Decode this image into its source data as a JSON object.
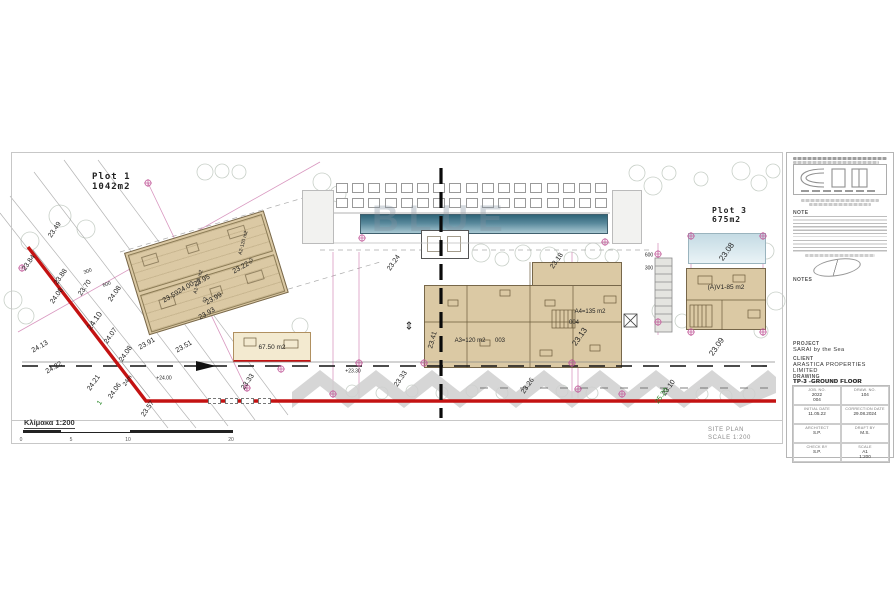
{
  "sheet": {
    "plot1": {
      "name": "Plot 1",
      "area": "1042m2"
    },
    "plot3": {
      "name": "Plot 3",
      "area": "675m2"
    },
    "scale_caption": "Κλίμακα 1:200",
    "scale_ticks": [
      "0",
      "5",
      "10",
      "20"
    ],
    "site_plan": {
      "line1": "SITE PLAN",
      "line2": "SCALE 1:200"
    },
    "watermark": "BLUE",
    "north_symbol": "⇕"
  },
  "units": {
    "a3": {
      "label": "A3=120 m2",
      "num": "003"
    },
    "a4": {
      "label": "A4=135 m2",
      "num": "004"
    },
    "av1": {
      "label": "(A)V1-85 m2"
    },
    "b67": {
      "label": "67.50 m2"
    }
  },
  "labels": [
    {
      "t": "23.49",
      "x": 55,
      "y": 230,
      "r": -55
    },
    {
      "t": "23.84",
      "x": 29,
      "y": 263,
      "r": -55
    },
    {
      "t": "23.88",
      "x": 61,
      "y": 277,
      "r": -55
    },
    {
      "t": "24.08",
      "x": 57,
      "y": 296,
      "r": -55
    },
    {
      "t": "23.70",
      "x": 85,
      "y": 288,
      "r": -55
    },
    {
      "t": "24.08",
      "x": 115,
      "y": 294,
      "r": -55
    },
    {
      "t": "24.10",
      "x": 95,
      "y": 321,
      "r": -55,
      "s": 8
    },
    {
      "t": "24.07",
      "x": 111,
      "y": 336,
      "r": -55
    },
    {
      "t": "24.13",
      "x": 40,
      "y": 347,
      "r": -30
    },
    {
      "t": "24.08",
      "x": 126,
      "y": 354,
      "r": -55
    },
    {
      "t": "24.22",
      "x": 54,
      "y": 368,
      "r": -30
    },
    {
      "t": "24.21",
      "x": 94,
      "y": 383,
      "r": -55
    },
    {
      "t": "24.06",
      "x": 115,
      "y": 391,
      "r": -55
    },
    {
      "t": "23.57",
      "x": 148,
      "y": 409,
      "r": -55
    },
    {
      "t": "23.95",
      "x": 202,
      "y": 281,
      "r": -30
    },
    {
      "t": "24.00",
      "x": 186,
      "y": 288,
      "r": -30
    },
    {
      "t": "23.99",
      "x": 214,
      "y": 299,
      "r": -30
    },
    {
      "t": "23.93",
      "x": 207,
      "y": 314,
      "r": -30
    },
    {
      "t": "23.59",
      "x": 171,
      "y": 297,
      "r": -30
    },
    {
      "t": "23.91",
      "x": 147,
      "y": 344,
      "r": -30
    },
    {
      "t": "23.51",
      "x": 184,
      "y": 347,
      "r": -30
    },
    {
      "t": "23.22",
      "x": 241,
      "y": 268,
      "r": -30
    },
    {
      "t": "23.24",
      "x": 394,
      "y": 263,
      "r": -55
    },
    {
      "t": "23.18",
      "x": 557,
      "y": 261,
      "r": -55
    },
    {
      "t": "23.33",
      "x": 248,
      "y": 382,
      "r": -55
    },
    {
      "t": "23.33",
      "x": 401,
      "y": 379,
      "r": -55
    },
    {
      "t": "23.26",
      "x": 528,
      "y": 386,
      "r": -55
    },
    {
      "t": "23.13",
      "x": 580,
      "y": 337,
      "r": -55,
      "s": 8
    },
    {
      "t": "23.41",
      "x": 433,
      "y": 340,
      "r": -75
    },
    {
      "t": "23.08",
      "x": 727,
      "y": 252,
      "r": -55,
      "s": 8
    },
    {
      "t": "23.09",
      "x": 717,
      "y": 347,
      "r": -55,
      "s": 8
    },
    {
      "t": "23.10",
      "x": 669,
      "y": 388,
      "r": -55
    },
    {
      "t": "25.20",
      "x": 662,
      "y": 396,
      "r": -55,
      "c": "#2e8b2e"
    },
    {
      "t": "1",
      "x": 100,
      "y": 403,
      "r": -55,
      "c": "#2e8b2e"
    },
    {
      "t": "24m",
      "x": 128,
      "y": 381,
      "r": -55,
      "s": 6
    },
    {
      "t": "+24.00",
      "x": 164,
      "y": 379,
      "r": 0,
      "s": 5
    },
    {
      "t": "+23.30",
      "x": 353,
      "y": 372,
      "r": 0,
      "s": 5
    },
    {
      "t": "300",
      "x": 88,
      "y": 272,
      "r": -20,
      "s": 5
    },
    {
      "t": "600",
      "x": 107,
      "y": 285,
      "r": -20,
      "s": 5
    },
    {
      "t": "600",
      "x": 649,
      "y": 256,
      "r": 0,
      "s": 5
    },
    {
      "t": "300",
      "x": 649,
      "y": 269,
      "r": 0,
      "s": 5
    },
    {
      "t": "A2-120 m2",
      "x": 244,
      "y": 243,
      "r": -75,
      "s": 5
    },
    {
      "t": "02",
      "x": 252,
      "y": 261,
      "r": -75,
      "s": 5
    },
    {
      "t": "A1-120 m2",
      "x": 199,
      "y": 282,
      "r": -75,
      "s": 5
    },
    {
      "t": "02",
      "x": 206,
      "y": 300,
      "r": -75,
      "s": 5
    }
  ],
  "title_block": {
    "note_label": "NOTE",
    "notes_label": "NOTES",
    "project_label": "PROJECT",
    "project": "SARAI by the Sea",
    "client_label": "CLIENT",
    "client": "ARASTICA PROPERTIES\nLIMITED",
    "drawing_label": "DRAWING",
    "drawing": "TP-3 -GROUND FLOOR",
    "fields": [
      {
        "label": "JOB. NO.",
        "value": "2022\n004"
      },
      {
        "label": "DRAW. NO.",
        "value": "104"
      },
      {
        "label": "INITIAL DATE",
        "value": "11.05.22"
      },
      {
        "label": "CORRECTION DATE",
        "value": "29.08.2024"
      },
      {
        "label": "ARCHITECT",
        "value": "S.P."
      },
      {
        "label": "DRAFT BY",
        "value": "M.S."
      },
      {
        "label": "CHECK BY",
        "value": "S.P."
      },
      {
        "label": "SCALE",
        "value": "A1\n1:200"
      }
    ]
  },
  "colors": {
    "boundary_red": "#c41212",
    "survey_magenta": "#c45f9d",
    "building_tan": "#dbc9a4",
    "pool_blue": "#2e6478",
    "elevation_green": "#2e8b2e"
  }
}
